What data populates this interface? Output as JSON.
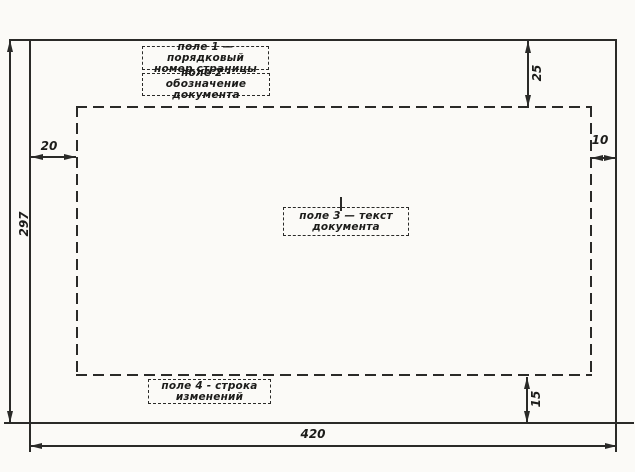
{
  "drawing": {
    "field_labels": {
      "field1": {
        "line1": "поле 1 — порядковый",
        "line2": "номер страницы"
      },
      "field2": {
        "line1": "поле 2 - обозначение",
        "line2": "документа"
      },
      "field3": {
        "line1": "поле 3 — текст",
        "line2": "документа"
      },
      "field4": {
        "line1": "поле 4 - строка",
        "line2": "изменений"
      }
    },
    "dimensions": {
      "sheet_height": "297",
      "sheet_width": "420",
      "margin_top": "25",
      "margin_left": "20",
      "margin_right": "10",
      "margin_bottom": "15"
    },
    "colors": {
      "ink": "#2a2a28",
      "paper": "#fbfaf7"
    }
  }
}
